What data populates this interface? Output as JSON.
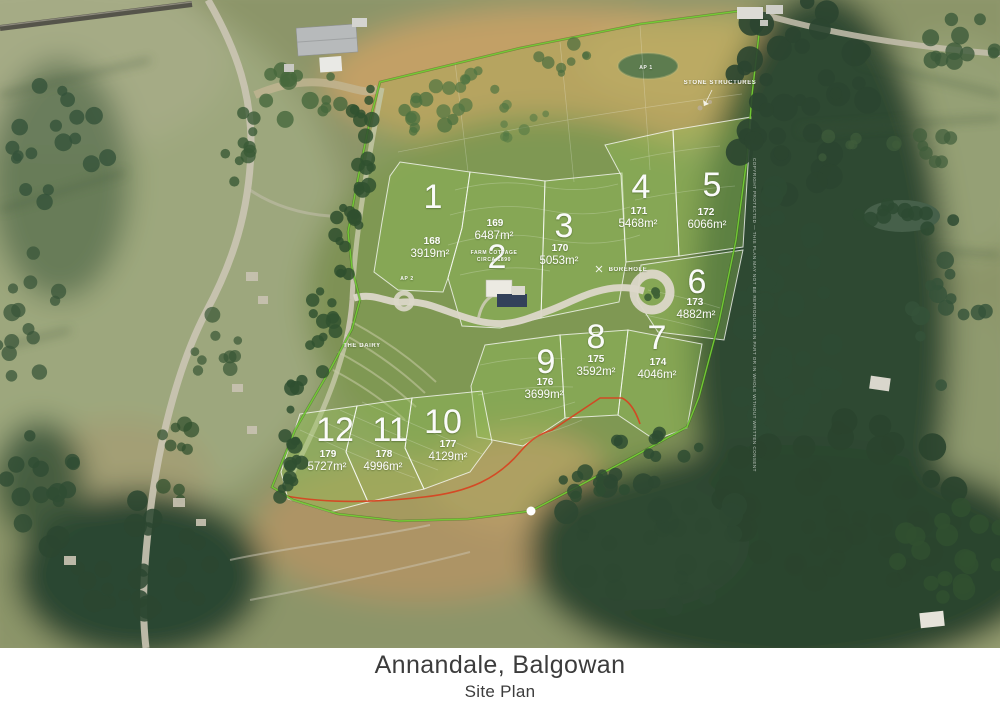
{
  "title": {
    "line1": "Annandale, Balgowan",
    "line2": "Site Plan"
  },
  "lots": [
    {
      "id": "1",
      "erf": "168",
      "area": "3919m²",
      "num": {
        "x": 433,
        "y": 208
      },
      "erf_pos": {
        "x": 432,
        "y": 244
      },
      "area_pos": {
        "x": 430,
        "y": 257
      }
    },
    {
      "id": "2",
      "erf": "169",
      "area": "6487m²",
      "num": {
        "x": 497,
        "y": 268
      },
      "erf_pos": {
        "x": 495,
        "y": 226
      },
      "area_pos": {
        "x": 494,
        "y": 239
      }
    },
    {
      "id": "3",
      "erf": "170",
      "area": "5053m²",
      "num": {
        "x": 564,
        "y": 237
      },
      "erf_pos": {
        "x": 560,
        "y": 251
      },
      "area_pos": {
        "x": 559,
        "y": 264
      }
    },
    {
      "id": "4",
      "erf": "171",
      "area": "5468m²",
      "num": {
        "x": 641,
        "y": 198
      },
      "erf_pos": {
        "x": 639,
        "y": 214
      },
      "area_pos": {
        "x": 638,
        "y": 227
      }
    },
    {
      "id": "5",
      "erf": "172",
      "area": "6066m²",
      "num": {
        "x": 712,
        "y": 196
      },
      "erf_pos": {
        "x": 706,
        "y": 215
      },
      "area_pos": {
        "x": 707,
        "y": 228
      }
    },
    {
      "id": "6",
      "erf": "173",
      "area": "4882m²",
      "num": {
        "x": 697,
        "y": 293
      },
      "erf_pos": {
        "x": 695,
        "y": 305
      },
      "area_pos": {
        "x": 696,
        "y": 318
      }
    },
    {
      "id": "7",
      "erf": "174",
      "area": "4046m²",
      "num": {
        "x": 657,
        "y": 349
      },
      "erf_pos": {
        "x": 658,
        "y": 365
      },
      "area_pos": {
        "x": 657,
        "y": 378
      }
    },
    {
      "id": "8",
      "erf": "175",
      "area": "3592m²",
      "num": {
        "x": 596,
        "y": 348
      },
      "erf_pos": {
        "x": 596,
        "y": 362
      },
      "area_pos": {
        "x": 596,
        "y": 375
      }
    },
    {
      "id": "9",
      "erf": "176",
      "area": "3699m²",
      "num": {
        "x": 546,
        "y": 373
      },
      "erf_pos": {
        "x": 545,
        "y": 385
      },
      "area_pos": {
        "x": 544,
        "y": 398
      }
    },
    {
      "id": "10",
      "erf": "177",
      "area": "4129m²",
      "num": {
        "x": 443,
        "y": 433
      },
      "erf_pos": {
        "x": 448,
        "y": 447
      },
      "area_pos": {
        "x": 448,
        "y": 460
      }
    },
    {
      "id": "11",
      "erf": "178",
      "area": "4996m²",
      "num": {
        "x": 390,
        "y": 441
      },
      "erf_pos": {
        "x": 384,
        "y": 457
      },
      "area_pos": {
        "x": 383,
        "y": 470
      }
    },
    {
      "id": "12",
      "erf": "179",
      "area": "5727m²",
      "num": {
        "x": 335,
        "y": 441
      },
      "erf_pos": {
        "x": 328,
        "y": 457
      },
      "area_pos": {
        "x": 327,
        "y": 470
      }
    }
  ],
  "map_labels": [
    {
      "id": "stone-structures",
      "text": "STONE STRUCTURES",
      "x": 720,
      "y": 84,
      "size": 6
    },
    {
      "id": "borehole",
      "text": "BOREHOLE",
      "x": 628,
      "y": 271,
      "size": 6
    },
    {
      "id": "the-dairy",
      "text": "THE DAIRY",
      "x": 362,
      "y": 347,
      "size": 6
    },
    {
      "id": "ap-1",
      "text": "AP 1",
      "x": 646,
      "y": 69,
      "size": 5
    },
    {
      "id": "ap-2",
      "text": "AP 2",
      "x": 407,
      "y": 280,
      "size": 5
    },
    {
      "id": "farm-cottage",
      "text": "FARM COTTAGE",
      "x": 494,
      "y": 254,
      "size": 5
    },
    {
      "id": "farm-cottage-date",
      "text": "CIRCA 1890",
      "x": 494,
      "y": 261,
      "size": 5
    }
  ],
  "copyright_notice": "COPYRIGHT PROTECTED — THIS PLAN MAY NOT BE REPRODUCED IN PART OR IN WHOLE WITHOUT WRITTEN CONSENT",
  "colors": {
    "boundary_green": "#74ce35",
    "lot_wash": "rgba(150,195,90,0.35)",
    "red_line": "#d8401f",
    "road": "#dcd7c9",
    "title_text": "#3c3c3c"
  }
}
